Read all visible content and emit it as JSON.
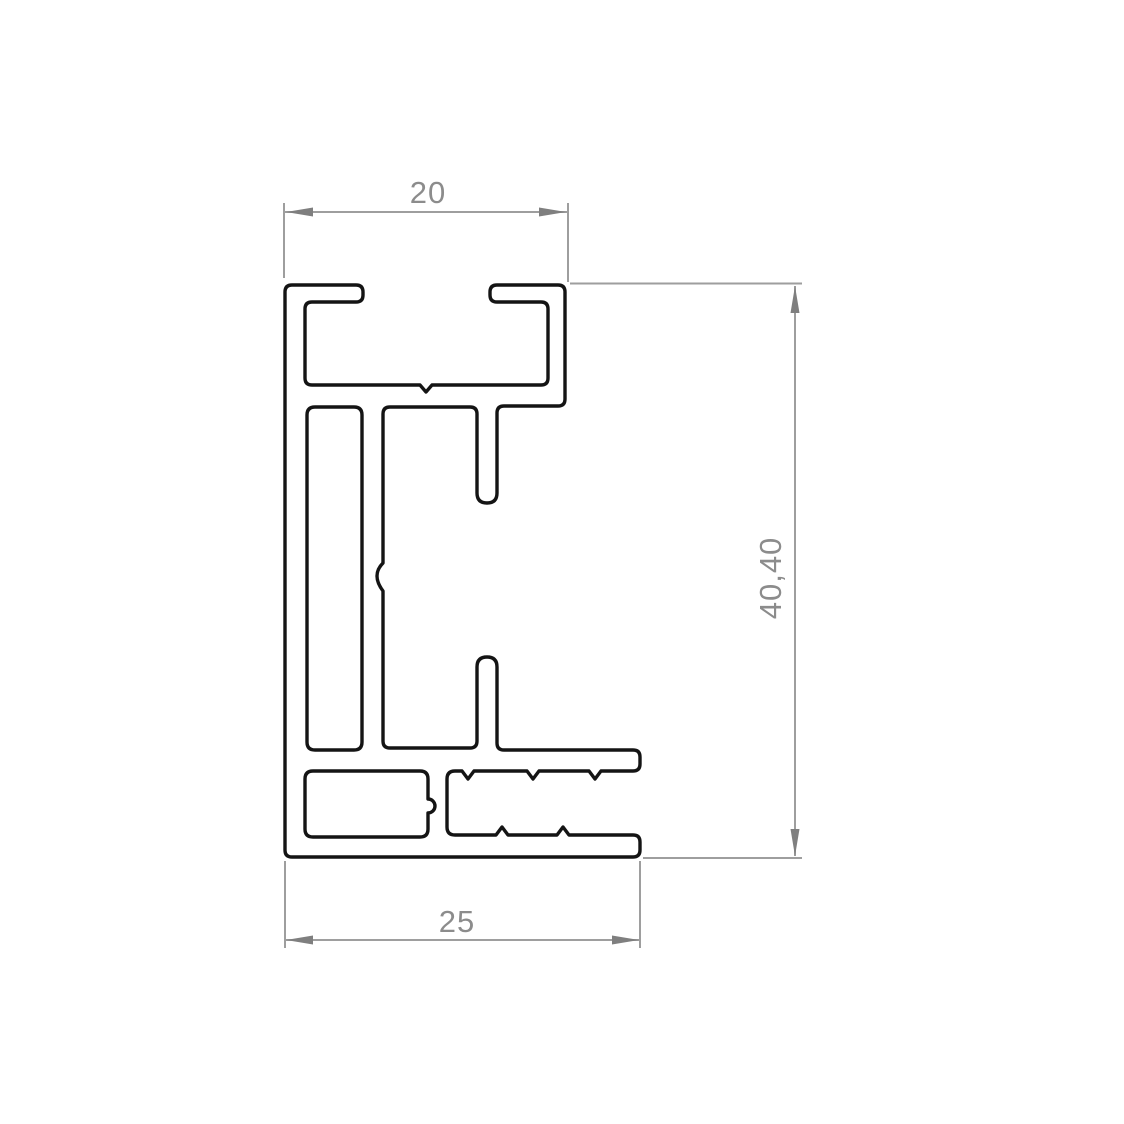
{
  "drawing": {
    "dimensions": {
      "top_width": "20",
      "bottom_width": "25",
      "overall_height": "40,40"
    },
    "colors": {
      "outline": "#141414",
      "dimension_line": "#9e9e9e",
      "arrow": "#7f7f7f",
      "text": "#8c8c8c",
      "background": "#ffffff"
    }
  }
}
